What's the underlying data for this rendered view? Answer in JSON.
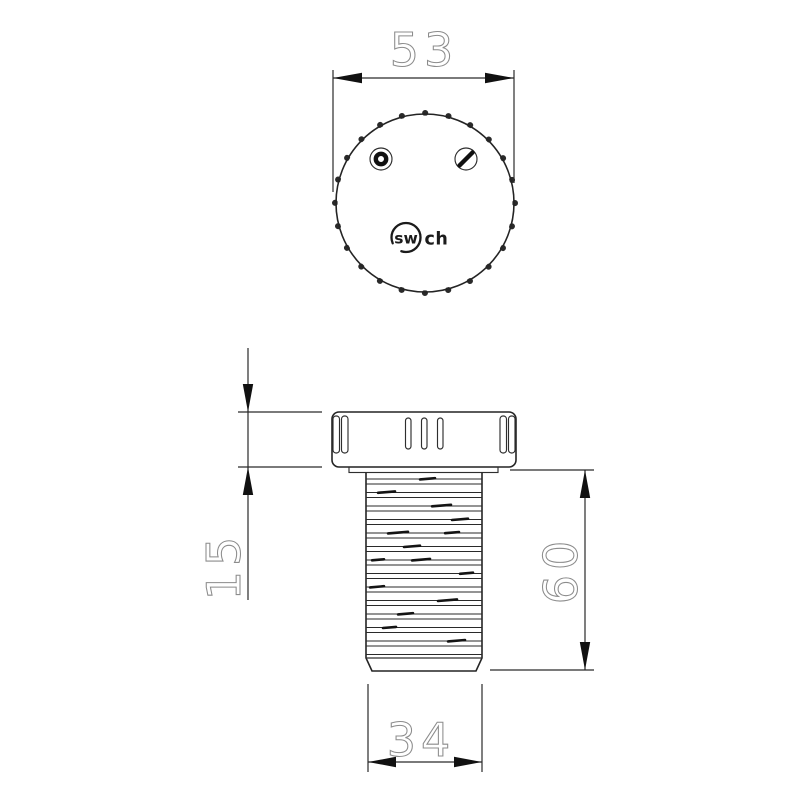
{
  "drawing": {
    "kind": "technical-dimension-drawing",
    "views": {
      "top_view": "cartridge dial top view",
      "side_view": "cartridge cap and threaded body side view"
    },
    "logo": {
      "prefix": "sw",
      "suffix": "ch",
      "full_name": "swich"
    },
    "dimensions": {
      "cap_diameter": "53",
      "cap_height": "15",
      "body_length": "60",
      "thread_diameter": "34"
    },
    "colors": {
      "line": "#242424",
      "dimension_text": "#8c8c8c",
      "arrow": "#111111",
      "background": "#ffffff"
    }
  }
}
